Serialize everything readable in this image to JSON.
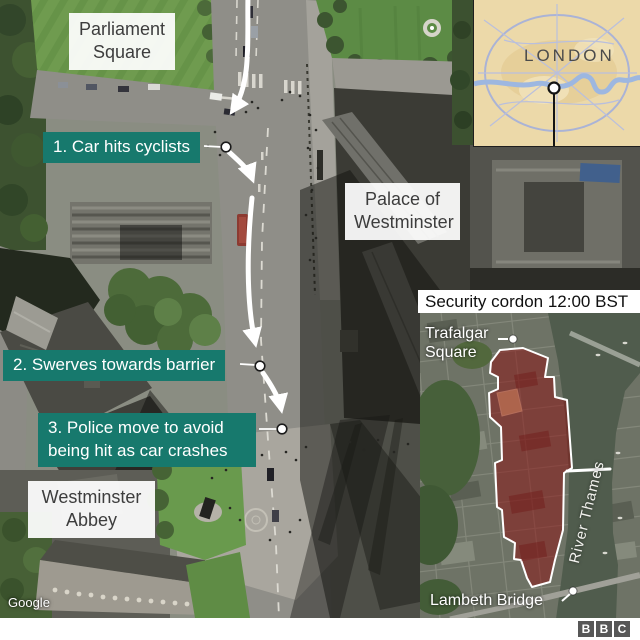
{
  "colors": {
    "teal": "#17796d",
    "cordon_red": "#8b1616",
    "route": "#ffffff"
  },
  "main_map": {
    "watermark": "Google",
    "place_labels": {
      "parliament_square": {
        "line1": "Parliament",
        "line2": "Square"
      },
      "palace_of_westminster": {
        "line1": "Palace of",
        "line2": "Westminster"
      },
      "westminster_abbey": {
        "line1": "Westminster",
        "line2": "Abbey"
      }
    },
    "event_labels": {
      "step1": "1. Car hits cyclists",
      "step2": "2. Swerves towards barrier",
      "step3_line1": "3. Police move to avoid",
      "step3_line2": "being hit as car crashes"
    }
  },
  "inset_london": {
    "name": "LONDON"
  },
  "inset_cordon": {
    "title": "Security cordon 12:00 BST",
    "trafalgar_line1": "Trafalgar",
    "trafalgar_line2": "Square",
    "river": "River Thames",
    "lambeth": "Lambeth Bridge"
  },
  "branding": {
    "b1": "B",
    "b2": "B",
    "b3": "C"
  }
}
